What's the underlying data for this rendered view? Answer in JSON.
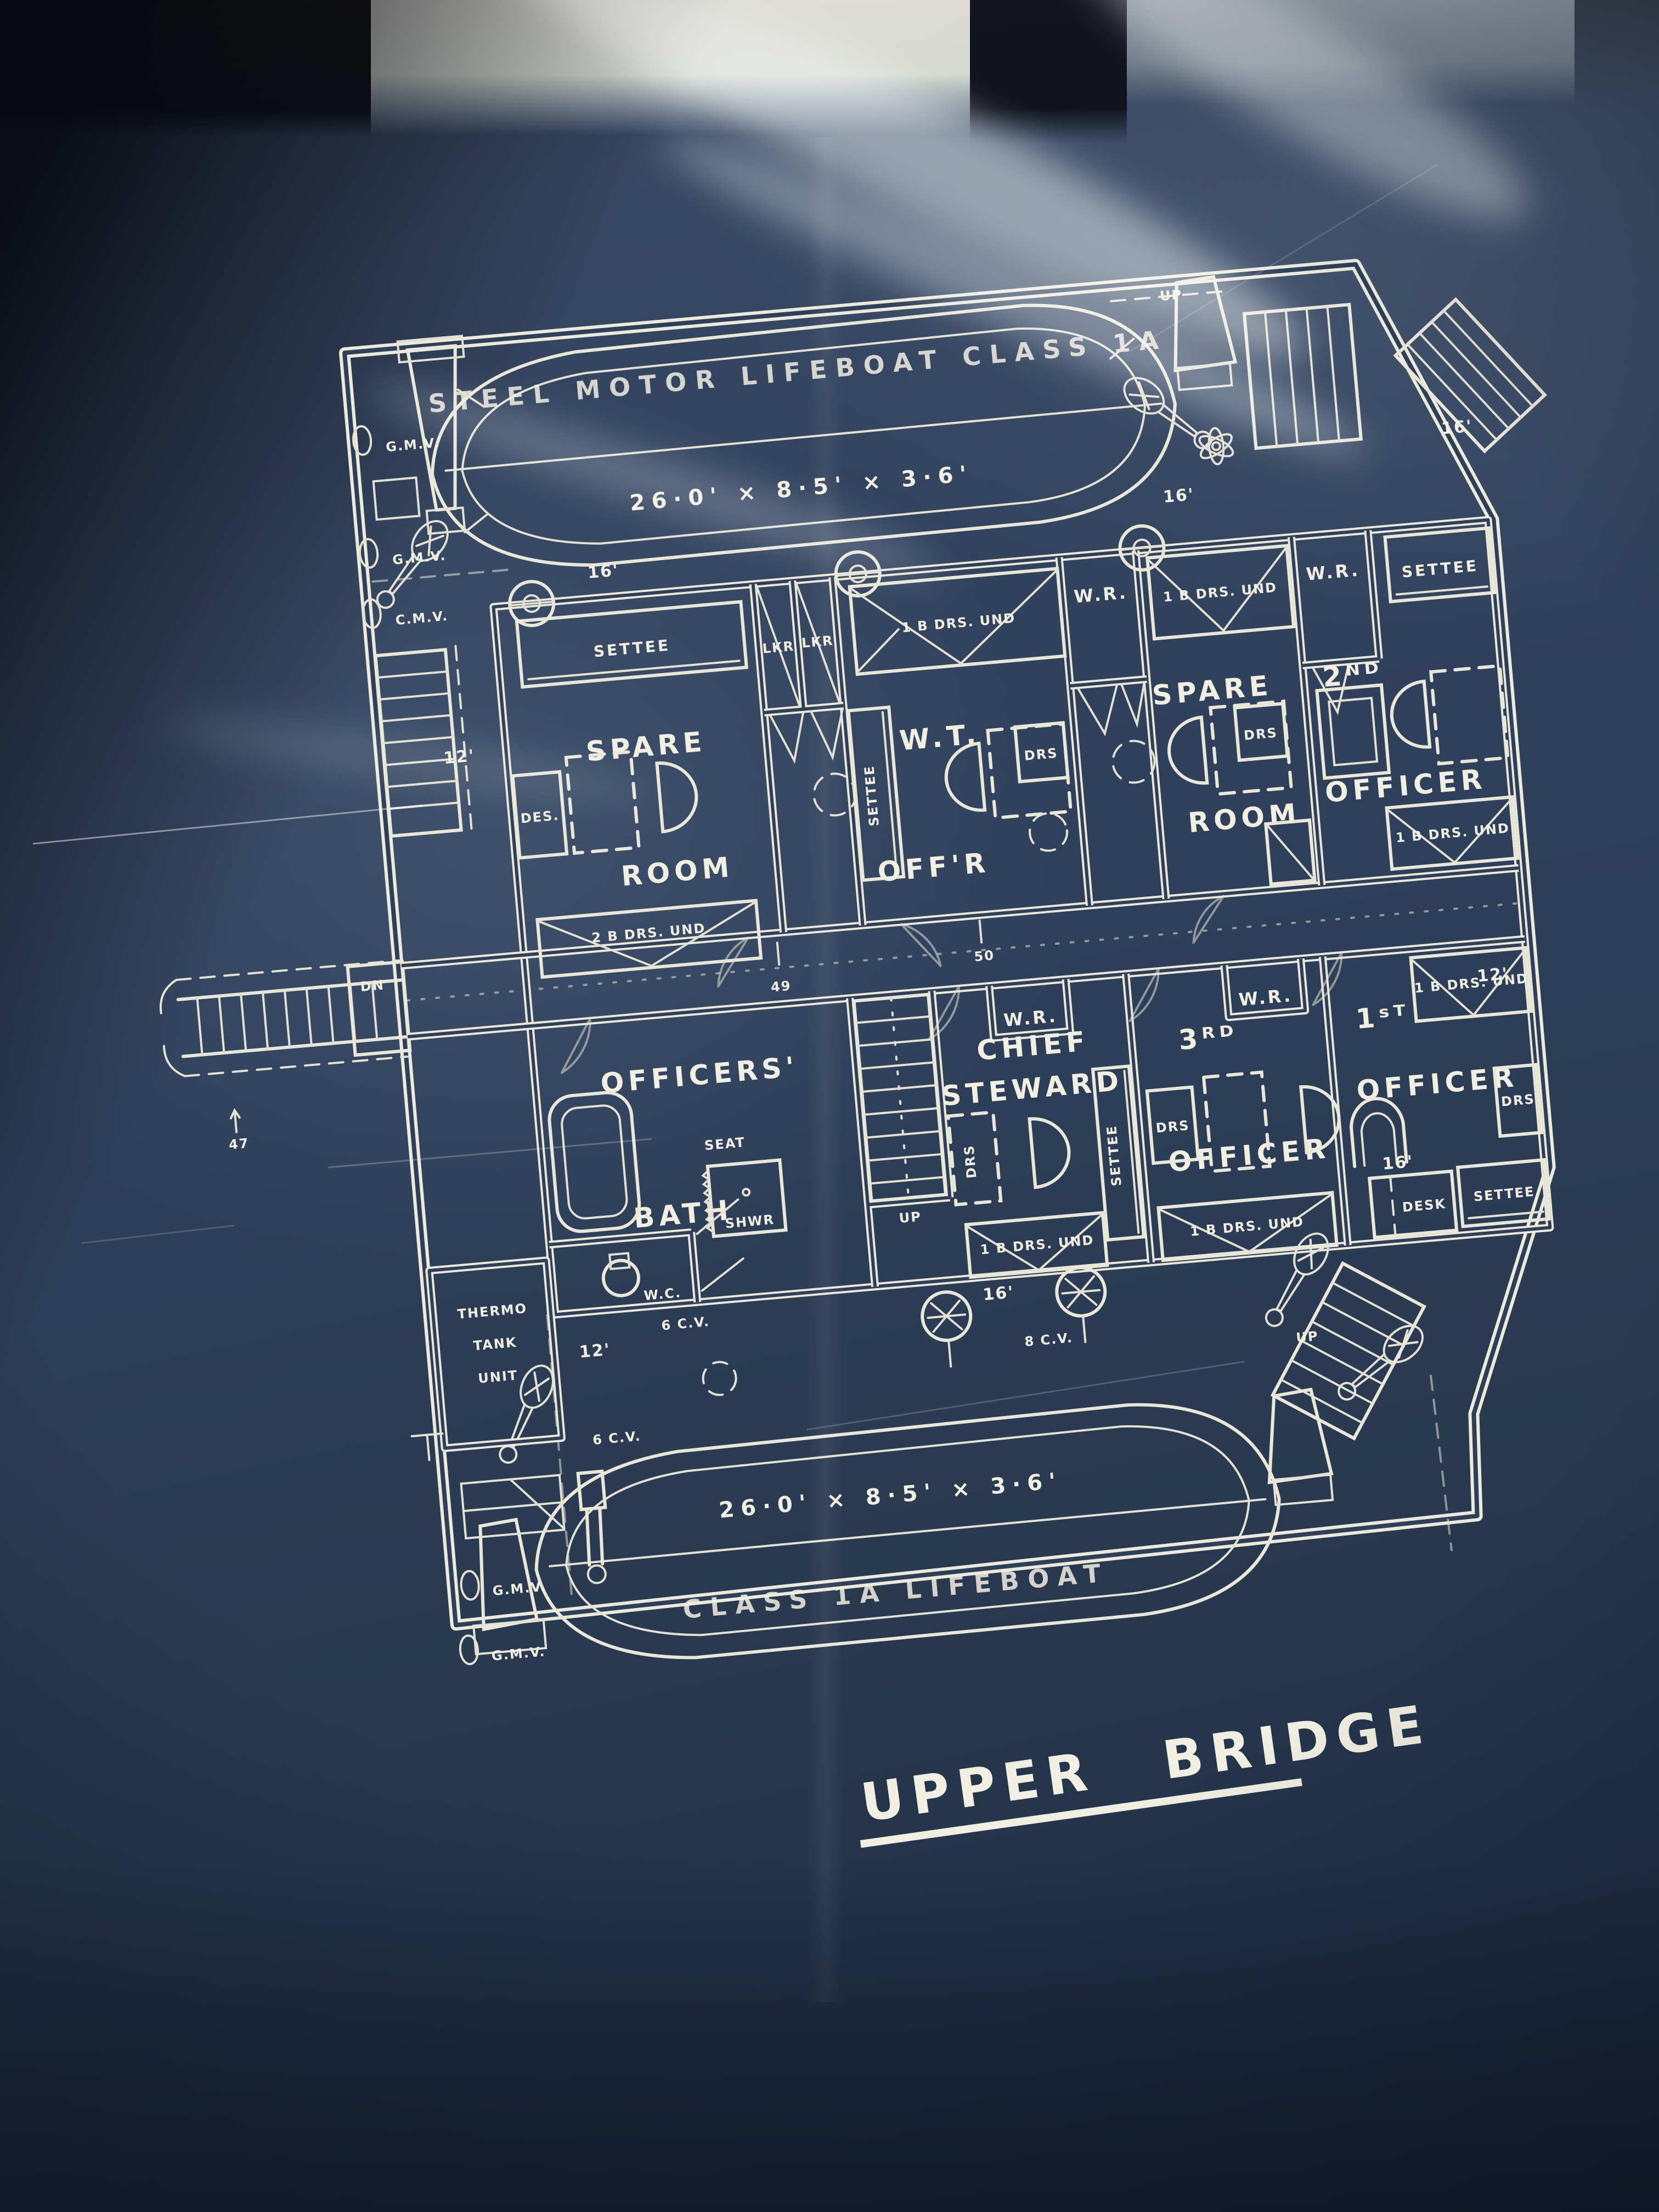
{
  "blueprint": {
    "title": "UPPER BRIDGE",
    "colors": {
      "paper": "#2e3f5a",
      "ink": "#eceadb"
    },
    "lifeboats": {
      "top": {
        "name": "STEEL MOTOR LIFEBOAT CLASS 1A",
        "size": "26·0' × 8·5' × 3·6'"
      },
      "bottom": {
        "name": "CLASS 1A LIFEBOAT",
        "size": "26·0' × 8·5' × 3·6'"
      }
    },
    "rooms": {
      "spare_port": {
        "l1": "SPARE",
        "l2": "ROOM"
      },
      "wt_officer": {
        "l1": "W.T.",
        "l2": "OFF'R"
      },
      "spare_stbd": {
        "l1": "SPARE",
        "l2": "ROOM"
      },
      "second_officer": {
        "l1": "2ᴺᴰ",
        "l2": "OFFICER"
      },
      "officers_bath": {
        "l1": "OFFICERS'",
        "l2": "BATH"
      },
      "chief_steward": {
        "l1": "CHIEF",
        "l2": "STEWARD"
      },
      "third_officer": {
        "l1": "3ᴿᴰ",
        "l2": "OFFICER"
      },
      "first_officer": {
        "l1": "1ˢᵀ",
        "l2": "OFFICER"
      }
    },
    "furniture": {
      "settee": "SETTEE",
      "seat": "SEAT",
      "desk": "DESK",
      "des": "DES.",
      "drs": "DRS",
      "lkr": "LKR",
      "wr": "W.R.",
      "wc": "W.C.",
      "shwr": "SHWR"
    },
    "berths": {
      "single": "1 B DRS. UND",
      "double": "2 B DRS. UND"
    },
    "equipment": {
      "thermo": {
        "l1": "THERMO",
        "l2": "TANK",
        "l3": "UNIT"
      },
      "gmv": "G.M.V.",
      "cmv": "C.M.V.",
      "cv8": "8 C.V.",
      "cv6": "6 C.V.",
      "up": "UP",
      "dn": "DN"
    },
    "dimensions": {
      "d16": "16'",
      "d12": "12'"
    },
    "frames": {
      "f47": "47",
      "f49": "49",
      "f50": "50"
    }
  }
}
